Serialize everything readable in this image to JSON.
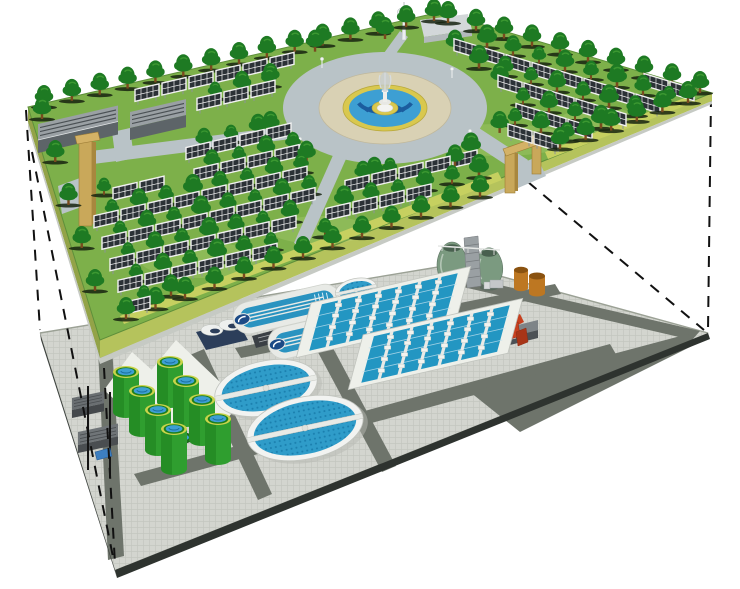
{
  "meta": {
    "title": "Cutaway concept illustration: landscaped solar park level lifted above an underground wastewater treatment plant level",
    "upper_label": "solar park with trees and central fountain plaza",
    "lower_label": "wastewater treatment plant platform",
    "connector_label": "dashed projection lines linking the two levels"
  },
  "colors": {
    "background": "#ffffff",
    "grass": "#7db04a",
    "grass_patch": "#c9e08a",
    "terrain_side_left": "#93a348",
    "terrain_side_right": "#b5c35c",
    "terrain_base": "#c6cac4",
    "hedge": "#c6d060",
    "tree_dark": "#1e7a23",
    "tree_light": "#3f9b33",
    "trunk": "#7a4a1e",
    "panel_cell": "#2b3136",
    "panel_frame": "#f2f2f2",
    "road_park": "#b9c3c7",
    "plaza_pavers": "#d9d1b4",
    "plaza_yellow": "#d9c84e",
    "water_blue": "#3d9fd3",
    "water_dark": "#1b5c9e",
    "shed_roof": "#9aa0a4",
    "shed_front": "#5d6468",
    "shed_stripe": "#4a5054",
    "gate_tan": "#c9a85a",
    "gate_dark": "#a8873e",
    "tower_white": "#eceff0",
    "bldg_gray": "#d3d7d9",
    "platform_paver": "#d3d5cf",
    "platform_paver_line": "#c3c6bf",
    "platform_road": "#6e746b",
    "platform_edge": "#2e332f",
    "pad_white": "#eef0ea",
    "clarifier_rim": "#f2f3f1",
    "clarifier_water": "#2f9cc9",
    "clarifier_dots": "#1a7fae",
    "basin_water": "#2396c2",
    "walkway": "#e8eae6",
    "digester_green": "#2f9e2f",
    "digester_dark": "#1d7f1d",
    "digester_rim": "#c9d44a",
    "egg_green": "#7b9a80",
    "egg_dark": "#49604f",
    "tank_orange": "#bd7722",
    "tank_orange_dark": "#8a5210",
    "navy": "#2c3e5a",
    "red_equipment": "#c6401f",
    "dash": "#111111"
  },
  "scene": {
    "fields": [
      {
        "kind": "L",
        "x": 58,
        "y": 96,
        "cols": 14,
        "rows": 12,
        "dcol": [
          27,
          -6.3
        ],
        "drow": [
          8,
          21.5
        ]
      },
      {
        "kind": "R",
        "x": 448,
        "y": 26,
        "cols": 10,
        "rows": 7,
        "dcol": [
          26,
          7.9
        ],
        "drow": [
          -8,
          20.5
        ]
      }
    ],
    "tree_grids": [
      {
        "kind": "L",
        "x": 72,
        "y": 108,
        "cols": 14,
        "rows": 12,
        "dcol": [
          27,
          -6.3
        ],
        "drow": [
          8,
          21.5
        ]
      },
      {
        "kind": "R",
        "x": 461,
        "y": 39,
        "cols": 10,
        "rows": 7,
        "dcol": [
          26,
          7.9
        ],
        "drow": [
          -8,
          20.5
        ]
      }
    ],
    "tree_lines": [
      {
        "from": [
          44,
          106
        ],
        "to": [
          434,
          20
        ],
        "n": 15
      },
      {
        "from": [
          448,
          22
        ],
        "to": [
          700,
          92
        ],
        "n": 10
      },
      {
        "from": [
          560,
          148
        ],
        "to": [
          688,
          102
        ],
        "n": 6
      },
      {
        "from": [
          126,
          318
        ],
        "to": [
          480,
          196
        ],
        "n": 13
      },
      {
        "from": [
          42,
          118
        ],
        "to": [
          95,
          290
        ],
        "n": 5
      }
    ],
    "plaza_ring_trees": {
      "cx": 385,
      "cy": 108,
      "rx": 122,
      "ry": 70,
      "angles": [
        20,
        55,
        95,
        130,
        160,
        200,
        235,
        270,
        305,
        340
      ]
    },
    "lamps": [
      [
        300,
        148
      ],
      [
        470,
        140
      ],
      [
        322,
        68
      ],
      [
        452,
        78
      ]
    ],
    "ovals": [
      {
        "cx": 287,
        "cy": 309
      },
      {
        "cx": 322,
        "cy": 334
      }
    ],
    "small_clarifiers": [
      {
        "cx": 356,
        "cy": 290,
        "rx": 17,
        "ry": 8.5
      },
      {
        "cx": 388,
        "cy": 306,
        "rx": 20,
        "ry": 10
      }
    ],
    "big_clarifiers": [
      {
        "cx": 266,
        "cy": 388,
        "rx": 45,
        "ry": 22
      },
      {
        "cx": 305,
        "cy": 428,
        "rx": 52,
        "ry": 26
      }
    ],
    "basins": [
      {
        "fl": [
          307,
          352
        ],
        "long": [
          140,
          -32
        ],
        "depth": [
          13,
          -48
        ],
        "strips": 6,
        "boxes": 4
      },
      {
        "fl": [
          359,
          384
        ],
        "long": [
          140,
          -32
        ],
        "depth": [
          13,
          -48
        ],
        "strips": 6,
        "boxes": 4
      }
    ],
    "digester_tops": [
      [
        170,
        362
      ],
      [
        126,
        372
      ],
      [
        186,
        381
      ],
      [
        142,
        391
      ],
      [
        202,
        400
      ],
      [
        158,
        410
      ],
      [
        218,
        419
      ],
      [
        174,
        429
      ]
    ],
    "ground_tank": {
      "cx": 180,
      "cy": 438
    },
    "dashes": [
      [
        26,
        110,
        40,
        330
      ],
      [
        32,
        152,
        114,
        562
      ],
      [
        104,
        368,
        115,
        564
      ],
      [
        711,
        96,
        708,
        331
      ],
      [
        528,
        182,
        704,
        330
      ]
    ]
  }
}
